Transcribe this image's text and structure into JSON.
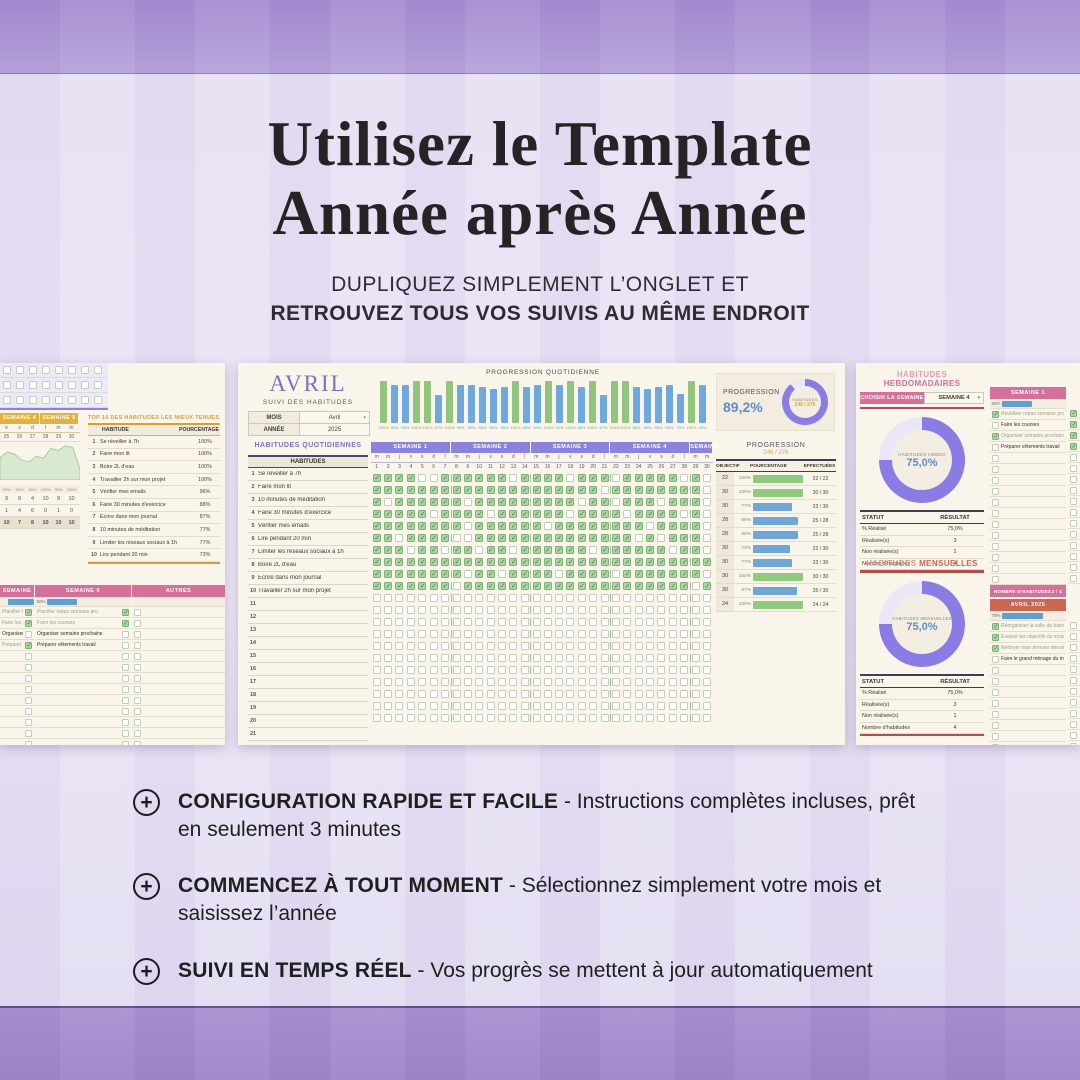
{
  "header": {
    "title_line1": "Utilisez le Template",
    "title_line2": "Année après Année",
    "subtitle_line1": "DUPLIQUEZ SIMPLEMENT L’ONGLET ET",
    "subtitle_line2": "RETROUVEZ TOUS VOS SUIVIS AU MÊME ENDROIT"
  },
  "bullets": [
    {
      "bold": "CONFIGURATION RAPIDE ET FACILE",
      "rest": " - Instructions complètes incluses, prêt en seulement 3 minutes"
    },
    {
      "bold": "COMMENCEZ À TOUT MOMENT",
      "rest": " - Sélectionnez simplement votre mois et saisissez l’année"
    },
    {
      "bold": "SUIVI EN TEMPS RÉEL",
      "rest": " - Vos progrès se mettent à jour automatiquement"
    }
  ],
  "center": {
    "month": "AVRIL",
    "subtitle": "SUIVI DES HABITUDES",
    "mois_label": "MOIS",
    "mois_value": "Avril",
    "annee_label": "ANNÉE",
    "annee_value": "2025",
    "daily_chart_title": "PROGRESSION QUOTIDIENNE",
    "daily_values": [
      100,
      90,
      90,
      100,
      100,
      67,
      100,
      90,
      90,
      85,
      80,
      85,
      100,
      85,
      90,
      100,
      90,
      100,
      85,
      100,
      67,
      100,
      100,
      85,
      80,
      85,
      90,
      70,
      100,
      90
    ],
    "progression_label": "PROGRESSION",
    "progression_value": "89,2%",
    "progression_pct": 89.2,
    "donut_label": "HABITUDES",
    "donut_value": "246 / 276",
    "section_title": "HABITUDES QUOTIDIENNES",
    "habits_header": "HABITUDES",
    "habits": [
      "Se réveiller à 7h",
      "Faire mon lit",
      "10 minutes de méditation",
      "Faire 30 minutes d'exercice",
      "Vérifier mes emails",
      "Lire pendant 20 min",
      "Limiter les réseaux sociaux à 1h",
      "Boire 2L d'eau",
      "Écrire dans mon journal",
      "Travailler 2h sur mon projet"
    ],
    "grid": [
      "111100111111011110111011111010",
      "111111111111111111110111111110",
      "101111110111111111011011101110",
      "111110111101111110111101111010",
      "111111110111111011111111011110",
      "110111100111111111111110101110",
      "111011011011011111101111110110",
      "111111111111111111111111111111",
      "111111110110111101111011111110",
      "111111101111111111111111111101"
    ],
    "empty_rows": 11,
    "weeks": [
      "SEMAINE 1",
      "SEMAINE 2",
      "SEMAINE 3",
      "SEMAINE 4",
      "SEMAINE 5"
    ],
    "week_spans": [
      7,
      7,
      7,
      7,
      2
    ],
    "day_letter_cycle": [
      "m",
      "m",
      "j",
      "v",
      "s",
      "d",
      "l"
    ],
    "table_title": "PROGRESSION",
    "table_subtitle": "246 / 276",
    "table_headers": [
      "OBJECTIF",
      "POURCENTAGE",
      "EFFECTUÉES"
    ],
    "table_rows": [
      {
        "obj": "22",
        "pct": "100%",
        "val": 100,
        "done": "22 / 22"
      },
      {
        "obj": "30",
        "pct": "100%",
        "val": 100,
        "done": "30 / 30"
      },
      {
        "obj": "30",
        "pct": "77%",
        "val": 77,
        "done": "23 / 30"
      },
      {
        "obj": "28",
        "pct": "89%",
        "val": 89,
        "done": "25 / 28"
      },
      {
        "obj": "28",
        "pct": "89%",
        "val": 89,
        "done": "25 / 28"
      },
      {
        "obj": "30",
        "pct": "73%",
        "val": 73,
        "done": "22 / 30"
      },
      {
        "obj": "30",
        "pct": "77%",
        "val": 77,
        "done": "23 / 30"
      },
      {
        "obj": "30",
        "pct": "100%",
        "val": 100,
        "done": "30 / 30"
      },
      {
        "obj": "30",
        "pct": "87%",
        "val": 87,
        "done": "26 / 30"
      },
      {
        "obj": "24",
        "pct": "100%",
        "val": 100,
        "done": "24 / 24"
      }
    ]
  },
  "left": {
    "week_headers": [
      "SEMAINE 4",
      "SEMAINE 5"
    ],
    "day_letters": [
      "v",
      "s",
      "d",
      "l",
      "m",
      "m"
    ],
    "day_numbers": [
      "25",
      "26",
      "27",
      "28",
      "29",
      "30"
    ],
    "area_values": [
      62,
      78,
      72,
      55,
      50,
      66,
      60,
      88,
      82,
      95,
      90,
      30
    ],
    "pct_row": [
      "90%",
      "80%",
      "50%",
      "100%",
      "90%",
      "100%"
    ],
    "count_rows": [
      [
        "9",
        "8",
        "4",
        "10",
        "9",
        "10"
      ],
      [
        "1",
        "4",
        "6",
        "0",
        "1",
        "0"
      ],
      [
        "10",
        "7",
        "8",
        "10",
        "10",
        "10"
      ]
    ],
    "top10_title": "TOP 10 DES HABITUDES LES MIEUX TENUES",
    "top10_headers": [
      "HABITUDE",
      "POURCENTAGE"
    ],
    "top10_rows": [
      [
        "1",
        "Se réveiller à 7h",
        "100%"
      ],
      [
        "2",
        "Faire mon lit",
        "100%"
      ],
      [
        "3",
        "Boire 2L d'eau",
        "100%"
      ],
      [
        "4",
        "Travailler 2h sur mon projet",
        "100%"
      ],
      [
        "5",
        "Vérifier mes emails",
        "96%"
      ],
      [
        "6",
        "Faire 30 minutes d'exercice",
        "88%"
      ],
      [
        "7",
        "Écrire dans mon journal",
        "87%"
      ],
      [
        "8",
        "10 minutes de méditation",
        "77%"
      ],
      [
        "9",
        "Limiter les réseaux sociaux à 1h",
        "77%"
      ],
      [
        "10",
        "Lire pendant 20 min",
        "73%"
      ]
    ],
    "footer_label": "NOMBRE D'HABITUDES",
    "checklists": [
      {
        "header": "SEMAINE 4",
        "pct": "",
        "bar": 70,
        "count": "3 / 4",
        "items": [
          {
            "t": "Planifier repas semaine pro",
            "on": 1,
            "dim": 1
          },
          {
            "t": "Faire les courses",
            "on": 1,
            "dim": 1
          },
          {
            "t": "Organiser semaine prochaine",
            "on": 0,
            "dim": 0
          },
          {
            "t": "Préparer vêtements travail",
            "on": 1,
            "dim": 1
          }
        ]
      },
      {
        "header": "SEMAINE 5",
        "pct": "50%",
        "bar": 55,
        "count": "2 / 4",
        "items": [
          {
            "t": "Planifier repas semaine pro",
            "on": 1,
            "dim": 1
          },
          {
            "t": "Faire les courses",
            "on": 1,
            "dim": 1
          },
          {
            "t": "Organiser semaine prochaine",
            "on": 0,
            "dim": 0
          },
          {
            "t": "Préparer vêtements travail",
            "on": 0,
            "dim": 0
          }
        ]
      },
      {
        "header": "AUTRES",
        "pct": "",
        "bar": 0,
        "count": "0 / 0",
        "items": []
      }
    ]
  },
  "right": {
    "s1_title_a": "HABITUDES ",
    "s1_title_b": "HEBDOMADAIRES",
    "choose_label": "CHOISIR LA SEMAINE",
    "week_value": "SEMAINE 4",
    "donut1_pct": 75,
    "donut1_label": "HABITUDES HEBDO",
    "donut1_value": "75,0%",
    "stats_headers": [
      "STATUT",
      "RÉSULTAT"
    ],
    "stats_rows": [
      [
        "% Réalisé",
        "75,0%"
      ],
      [
        "Réalisée(s)",
        "3"
      ],
      [
        "Non réalisée(s)",
        "1"
      ],
      [
        "Nombre d'habitudes",
        "4"
      ]
    ],
    "s2_title_a": "HABITUDES ",
    "s2_title_b": "MENSUELLES",
    "donut2_pct": 75,
    "donut2_label": "HABITUDES MENSUELLES",
    "donut2_value": "75,0%",
    "footer_label": "NOMBRE D'HABITUDES",
    "week_list": {
      "header": "SEMAINE 1",
      "pct": "50%",
      "bar": 55,
      "count": "2 / 4",
      "items": [
        {
          "t": "Réutiliser repas semaine pro",
          "on": 1,
          "dim": 1
        },
        {
          "t": "Faire les courses",
          "on": 0,
          "dim": 0
        },
        {
          "t": "Organiser semaine prochaine",
          "on": 1,
          "dim": 1
        },
        {
          "t": "Préparer vêtements travail",
          "on": 0,
          "dim": 0
        }
      ]
    },
    "month_list": {
      "header": "AVRIL 2025",
      "pct": "75%",
      "bar": 75,
      "count": "3 / 4",
      "items": [
        {
          "t": "Réorganiser la salle de bains",
          "on": 1,
          "dim": 1
        },
        {
          "t": "Évaluer les objectifs du mois",
          "on": 1,
          "dim": 1
        },
        {
          "t": "Nettoyer mon armoire dressing",
          "on": 1,
          "dim": 1
        },
        {
          "t": "Faire le grand ménage du mois",
          "on": 0,
          "dim": 0
        }
      ]
    },
    "week_strip": [
      1,
      1,
      1,
      1,
      0,
      0,
      0,
      0,
      0,
      0,
      0,
      0,
      0,
      0,
      0,
      0
    ],
    "month_strip": [
      0,
      0,
      0,
      0,
      0,
      0,
      0,
      0,
      0,
      0,
      0,
      0,
      0
    ]
  },
  "colors": {
    "band_purple": "#a78fd1",
    "background_lavender": "#e9e3f5",
    "week_header_purple": "#8d83dd",
    "pink": "#d4709a",
    "orange": "#cc6752",
    "gold": "#e3b13e",
    "bar_green": "#93c47d",
    "bar_blue": "#6fa8dc",
    "donut_purple": "#8b7be4",
    "value_blue": "#5b8fc9",
    "value_gold": "#d7a93f",
    "sheet_cream": "#f9f5ea"
  }
}
